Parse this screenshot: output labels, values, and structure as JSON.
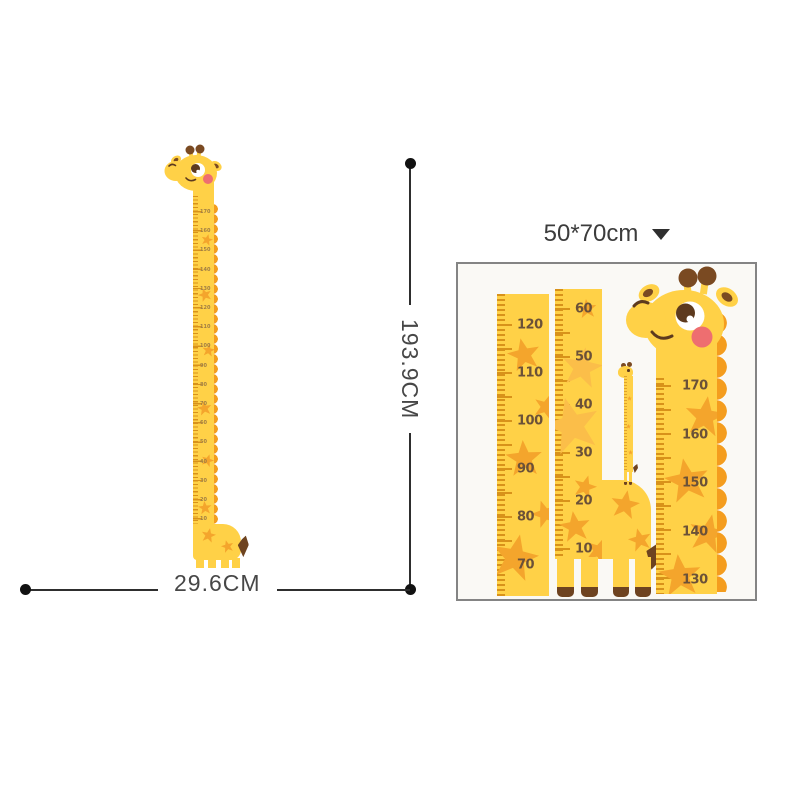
{
  "dimensions": {
    "height_label": "193.9CM",
    "width_label": "29.6CM"
  },
  "variant": {
    "size_label": "50*70cm",
    "dropdown_icon": "caret-down"
  },
  "left_chart": {
    "numbers": [
      "170",
      "160",
      "150",
      "140",
      "130",
      "120",
      "110",
      "100",
      "90",
      "80",
      "70",
      "60",
      "50",
      "40",
      "30",
      "20",
      "10"
    ]
  },
  "detail_card": {
    "left_ruler_numbers": [
      "120",
      "110",
      "100",
      "90",
      "80",
      "70"
    ],
    "middle_ruler_numbers": [
      "60",
      "50",
      "40",
      "30",
      "20",
      "10"
    ],
    "right_ruler_numbers": [
      "170",
      "160",
      "150",
      "140",
      "130"
    ]
  },
  "colors": {
    "giraffe_yellow": "#FFD147",
    "star_orange": "#F4A52C",
    "star_faded": "#FBBE49",
    "mane_orange": "#F49D1E",
    "tick_brown": "#D8921A",
    "number_brown": "#6B5138",
    "hoof_brown": "#6E4320",
    "cheek_pink": "#EE6E70",
    "dimension_line": "#2e2e2e",
    "card_border": "#848484",
    "card_background": "#FAF9F5"
  }
}
